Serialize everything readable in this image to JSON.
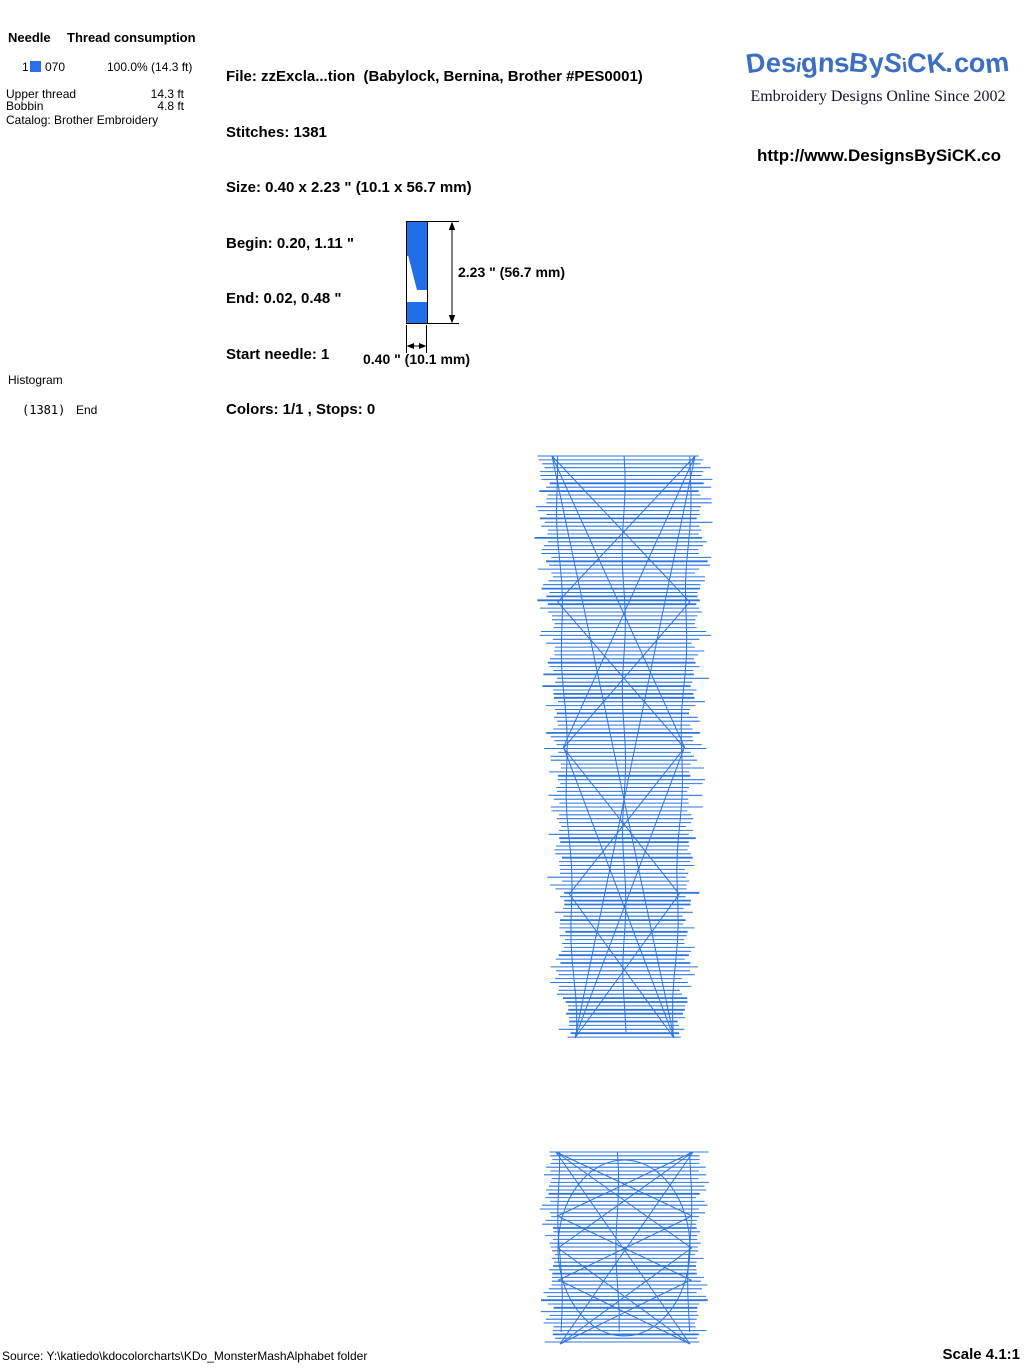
{
  "colors": {
    "design_blue": "#1f6fe8",
    "stitch_blue": "#2d74dd",
    "logo_blue": "#3c6fc2",
    "swatch_blue": "#2a70e8"
  },
  "header": {
    "needle_table": {
      "col_needle": "Needle",
      "col_consumption": "Thread consumption",
      "row": {
        "needle": "1",
        "thread_code": "070",
        "consumption": "100.0% (14.3 ft)"
      },
      "upper_thread_label": "Upper thread",
      "upper_thread_value": "14.3 ft",
      "bobbin_label": "Bobbin",
      "bobbin_value": "4.8 ft",
      "catalog": "Catalog: Brother Embroidery"
    },
    "file_info": {
      "file": "File: zzExcla...tion  (Babylock, Bernina, Brother #PES0001)",
      "stitches": "Stitches: 1381",
      "size": "Size: 0.40 x 2.23 \" (10.1 x 56.7 mm)",
      "begin": "Begin: 0.20, 1.11 \"",
      "end": "End: 0.02, 0.48 \"",
      "start_needle": "Start needle: 1",
      "colors": "Colors: 1/1 , Stops: 0"
    },
    "brand": {
      "logo_text": "DesignsBySiCK.com",
      "tagline": "Embroidery Designs Online Since 2002",
      "url": "http://www.DesignsBySiCK.co"
    }
  },
  "dimensions": {
    "height_label": "2.23 \" (56.7 mm)",
    "width_label": "0.40 \" (10.1 mm)"
  },
  "histogram": {
    "title": "Histogram",
    "count": "(1381)",
    "end_label": "End"
  },
  "footer": {
    "source": "Source: Y:\\katiedo\\kdocolorcharts\\KDo_MonsterMashAlphabet folder",
    "scale": "Scale 4.1:1"
  },
  "stitch_art": {
    "bar": {
      "y_top": 456,
      "y_bottom": 1038,
      "x_top_left": 545,
      "x_top_right": 702,
      "x_bottom_left": 568,
      "x_bottom_right": 681,
      "spacing": 3.9,
      "fringe": 16,
      "vertical_fracs": [
        0.07,
        0.5,
        0.93
      ],
      "zigzag_periods": [
        582,
        291,
        146
      ]
    },
    "dot": {
      "y_top": 1152,
      "y_bottom": 1344,
      "x_top_left": 549,
      "x_top_right": 700,
      "x_bottom_left": 553,
      "x_bottom_right": 697,
      "spacing": 3.8,
      "fringe": 12,
      "vertical_fracs": [
        0.06,
        0.45,
        0.94
      ],
      "zigzag_periods": [
        192,
        96,
        64
      ],
      "ellipse": {
        "cx": 624,
        "cy": 1248,
        "rx": 66,
        "ry": 88
      }
    }
  }
}
